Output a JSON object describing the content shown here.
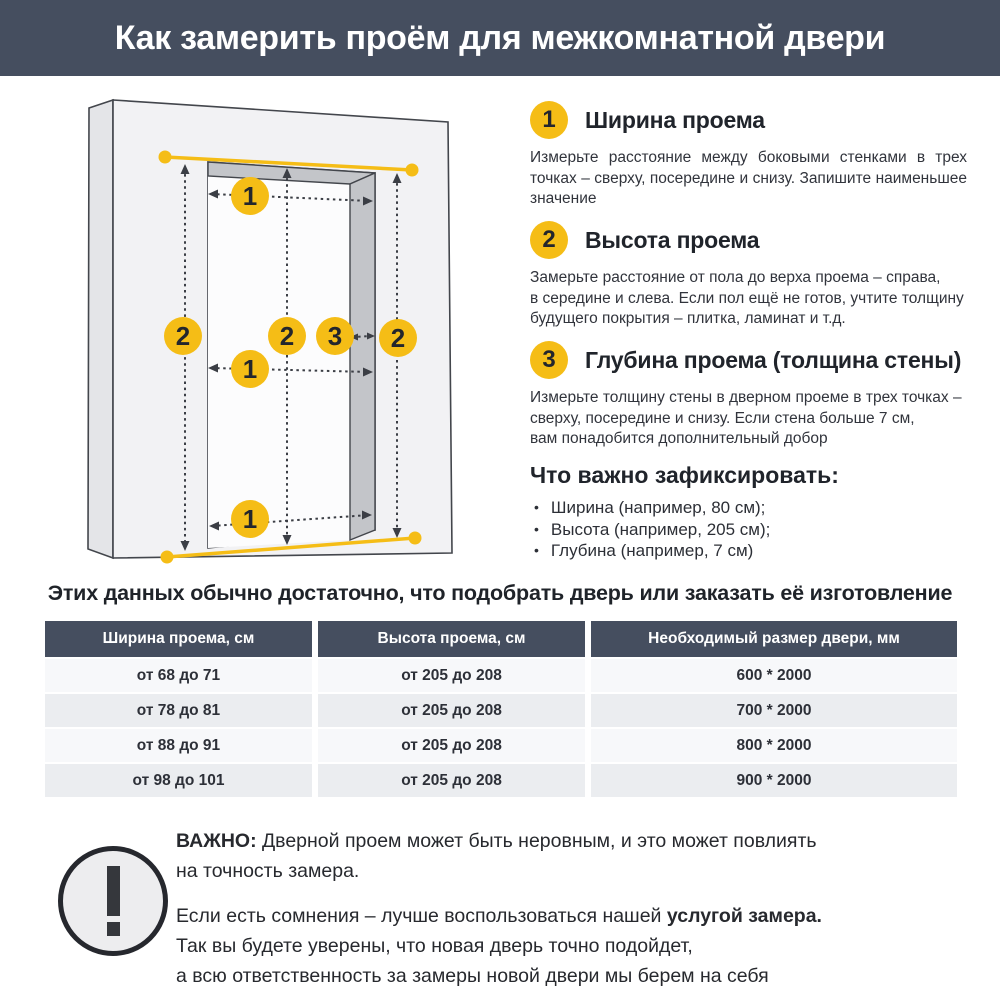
{
  "header": {
    "title": "Как замерить проём для межкомнатной двери",
    "bg_color": "#454e5f",
    "text_color": "#ffffff"
  },
  "colors": {
    "accent_yellow": "#f5bd16",
    "dark_slate": "#454e5f",
    "text_dark": "#23262d",
    "wall_front": "#f2f2f4",
    "wall_side": "#e4e5e8",
    "wall_reveal": "#c3c5c9",
    "table_row_light": "#f7f8fa",
    "table_row_gray": "#ebedf0"
  },
  "diagram": {
    "name": "door-opening-measurement-diagram",
    "labels": {
      "width": "1",
      "height": "2",
      "depth": "3"
    }
  },
  "steps": [
    {
      "num": "1",
      "title": "Ширина проема",
      "body": "Измерьте расстояние между боковыми стенками в трех точках – сверху, посередине и снизу. Запишите наименьшее значение"
    },
    {
      "num": "2",
      "title": "Высота проема",
      "body": "Замерьте расстояние от пола до верха проема – справа,\nв середине и слева. Если пол ещё не готов, учтите толщину будущего покрытия – плитка, ламинат и т.д."
    },
    {
      "num": "3",
      "title": "Глубина проема (толщина стены)",
      "body": "Измерьте толщину стены в дверном проеме в трех точках – сверху, посередине и снизу. Если стена больше 7 см,\nвам понадобится дополнительный добор"
    }
  ],
  "checklist": {
    "title": "Что важно зафиксировать:",
    "bullet": "•",
    "items": [
      "Ширина (например, 80 см);",
      "Высота (например, 205 см);",
      "Глубина (например, 7 см)"
    ]
  },
  "lead": "Этих данных обычно достаточно, что подобрать дверь или заказать её изготовление",
  "table": {
    "headers": [
      "Ширина проема, см",
      "Высота проема, см",
      "Необходимый размер двери, мм"
    ],
    "rows": [
      [
        "от 68 до 71",
        "от 205 до 208",
        "600 * 2000"
      ],
      [
        "от 78 до 81",
        "от 205 до 208",
        "700 * 2000"
      ],
      [
        "от 88 до 91",
        "от 205 до 208",
        "800 * 2000"
      ],
      [
        "от 98 до 101",
        "от 205 до 208",
        "900 * 2000"
      ]
    ]
  },
  "notice": {
    "icon": "exclamation-icon",
    "important_label": "ВАЖНО:",
    "important_text": " Дверной проем может быть неровным, и это может повлиять\nна точность замера.",
    "advice_pre": "Если есть сомнения – лучше воспользоваться нашей ",
    "advice_bold": "услугой замера.",
    "advice_rest": "\nТак вы будете уверены, что новая дверь точно подойдет,\nа всю ответственность за замеры новой двери мы берем на себя"
  }
}
